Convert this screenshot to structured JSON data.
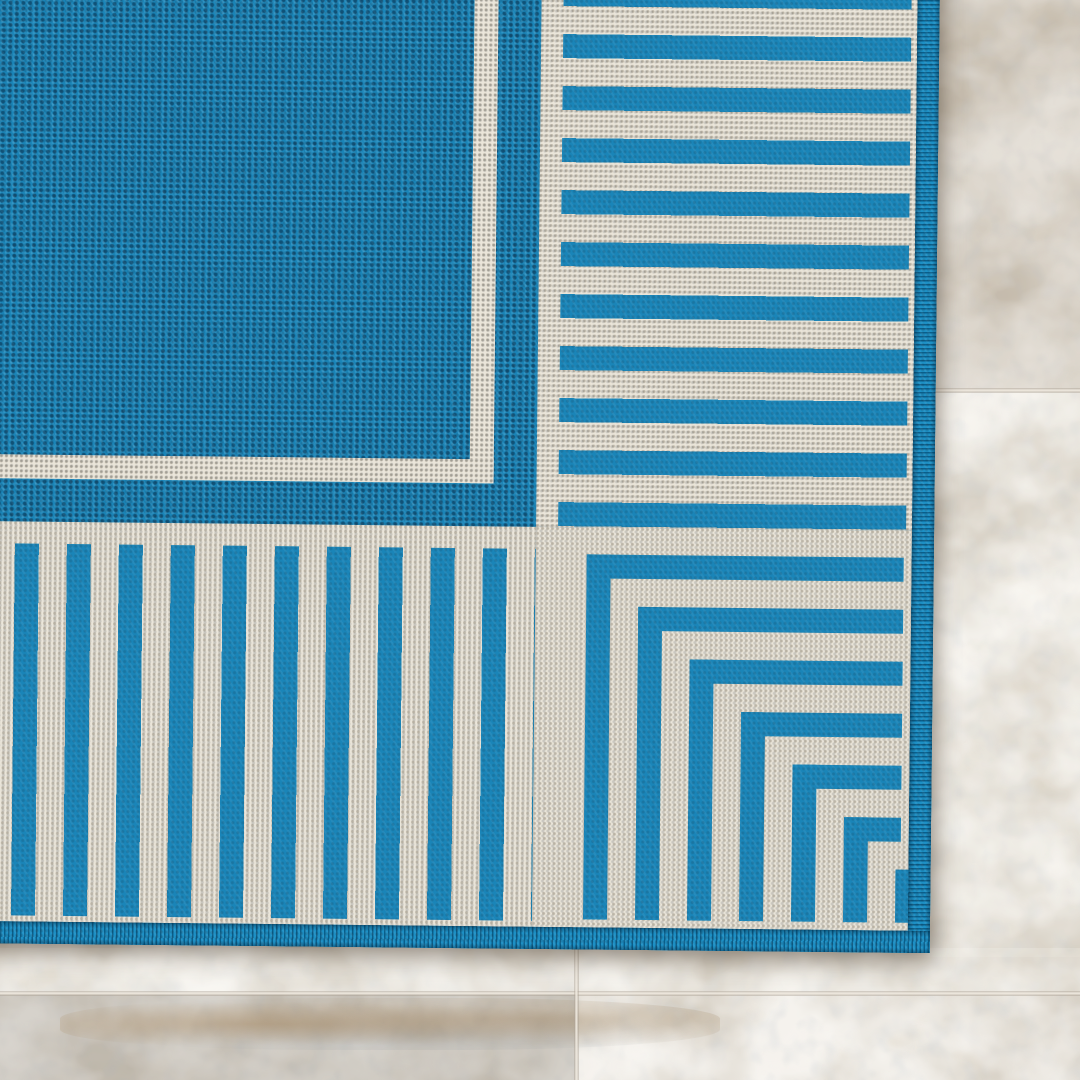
{
  "image": {
    "kind": "product-photo",
    "alt": "Close-up corner of a blue flat-weave indoor-outdoor rug with an ivory striped border, lying on beige travertine tile flooring"
  },
  "rug": {
    "field": "solid blue woven field",
    "inner_frame": "thin ivory pinstripe line",
    "border": "wide ivory band with blue pinstripes running perpendicular to the rug edges",
    "corner_motif": "nested blue right-angle brackets shrinking toward the rug corner",
    "binding": "blue serged edge binding on right and bottom edges",
    "corner_bracket_count": 7,
    "stripe_period_px": 52,
    "stripe_thickness_px": 24,
    "right_border_stripes_visible": 11,
    "bottom_border_stripes_visible": 10
  },
  "floor": {
    "material": "beige travertine tile",
    "joints": [
      "horizontal tile joint in right strip",
      "horizontal tile joint along bottom strip",
      "vertical tile joint in bottom strip"
    ]
  },
  "colors": {
    "rug_blue": "#1a85b8",
    "rug_blue_dark": "#0a3c60",
    "rug_blue_light": "#36a4d6",
    "ivory": "#eae5d9",
    "binding": "#0f83ba",
    "marble_base": "#cfc7ba",
    "marble_light": "#e7e2d9",
    "marble_gray": "#9aa3ac",
    "marble_tan": "#c0b09a",
    "grout": "#efe9df"
  }
}
